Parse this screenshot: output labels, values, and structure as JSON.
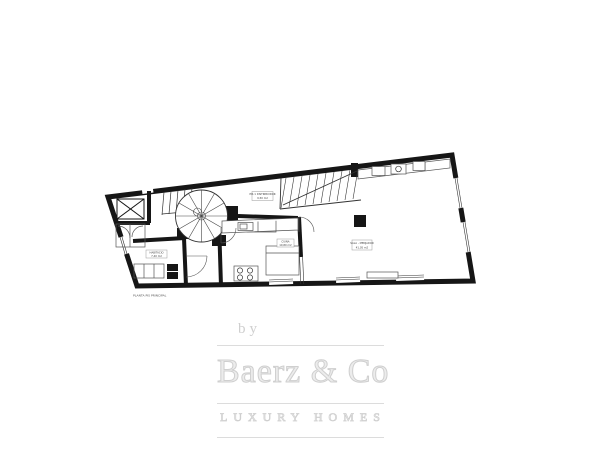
{
  "watermark": {
    "by": "by",
    "brand": "Baerz & Co",
    "tagline": "LUXURY HOMES",
    "color": "#d6d6d6"
  },
  "floorplan": {
    "ink": "#161616",
    "caption": "PLANTA PIS PRINCIPAL",
    "labels": {
      "hall": {
        "line1": "PIS 1 DISTRIBUIDOR",
        "line2": "9,50 m2"
      },
      "bedroom": {
        "line1": "HABITACIO",
        "line2": "7,40 m2"
      },
      "kitchen": {
        "line1": "CUINA",
        "line2": "10,80 m2"
      },
      "living": {
        "line1": "SALA - MENJADOR",
        "line2": "41,05 m2"
      }
    }
  }
}
